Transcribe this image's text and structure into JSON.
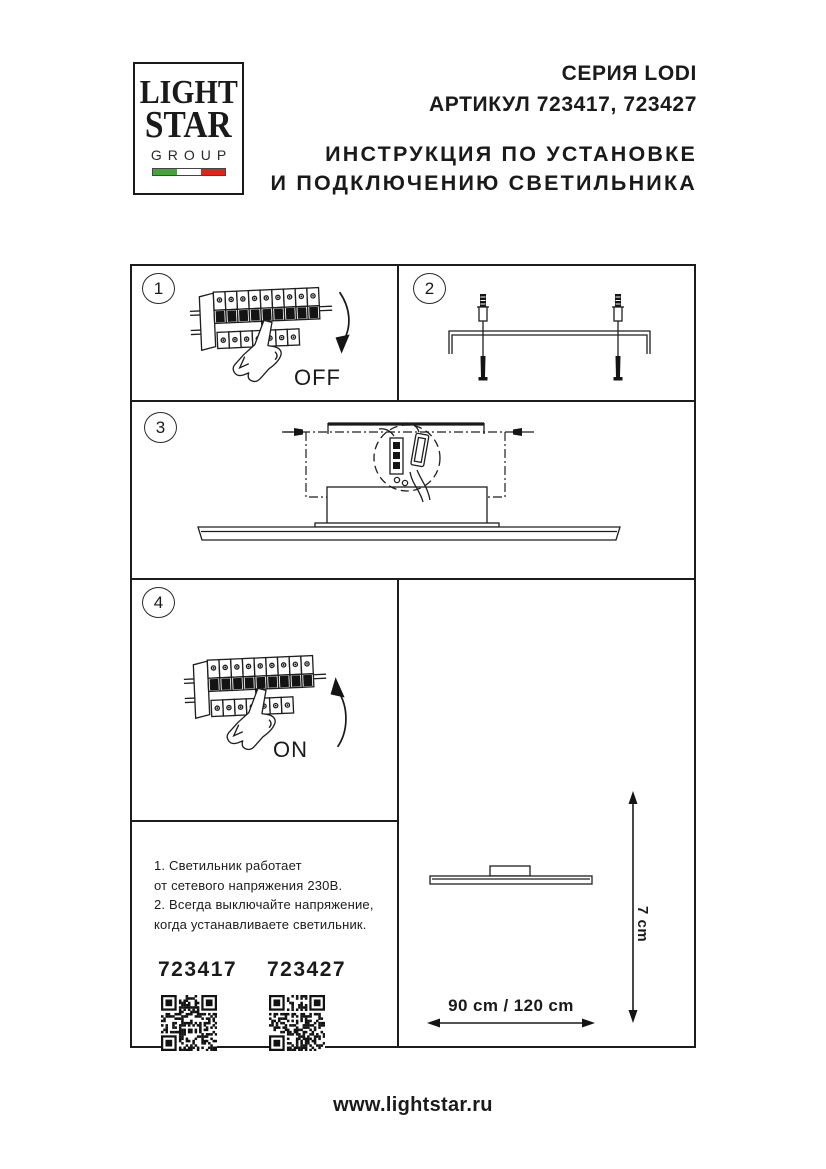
{
  "logo": {
    "line1": "LIGHT",
    "line2": "STAR",
    "line3": "GROUP",
    "flag_colors": {
      "green": "#43a536",
      "white": "#ffffff",
      "red": "#e2231a"
    }
  },
  "header": {
    "series": "СЕРИЯ LODI",
    "article": "АРТИКУЛ 723417, 723427",
    "instruction_line1": "ИНСТРУКЦИЯ ПО УСТАНОВКЕ",
    "instruction_line2": "И ПОДКЛЮЧЕНИЮ СВЕТИЛЬНИКА"
  },
  "steps": [
    {
      "number": "1",
      "switch_label": "OFF",
      "drawing": "circuit-breaker-switch-off"
    },
    {
      "number": "2",
      "drawing": "mounting-bracket-with-fasteners"
    },
    {
      "number": "3",
      "drawing": "fixture-installation-to-bracket"
    },
    {
      "number": "4",
      "switch_label": "ON",
      "drawing": "circuit-breaker-switch-on"
    }
  ],
  "notes": {
    "lines": [
      "1. Светильник работает",
      "от сетевого напряжения 230В.",
      "2. Всегда выключайте напряжение,",
      "когда устанавливаете светильник."
    ],
    "articles": [
      {
        "code": "723417"
      },
      {
        "code": "723427"
      }
    ]
  },
  "dimensions": {
    "width_label": "90 cm / 120 cm",
    "height_label": "7 cm"
  },
  "footer": {
    "website": "www.lightstar.ru"
  },
  "ink_color": "#1c1c1c"
}
